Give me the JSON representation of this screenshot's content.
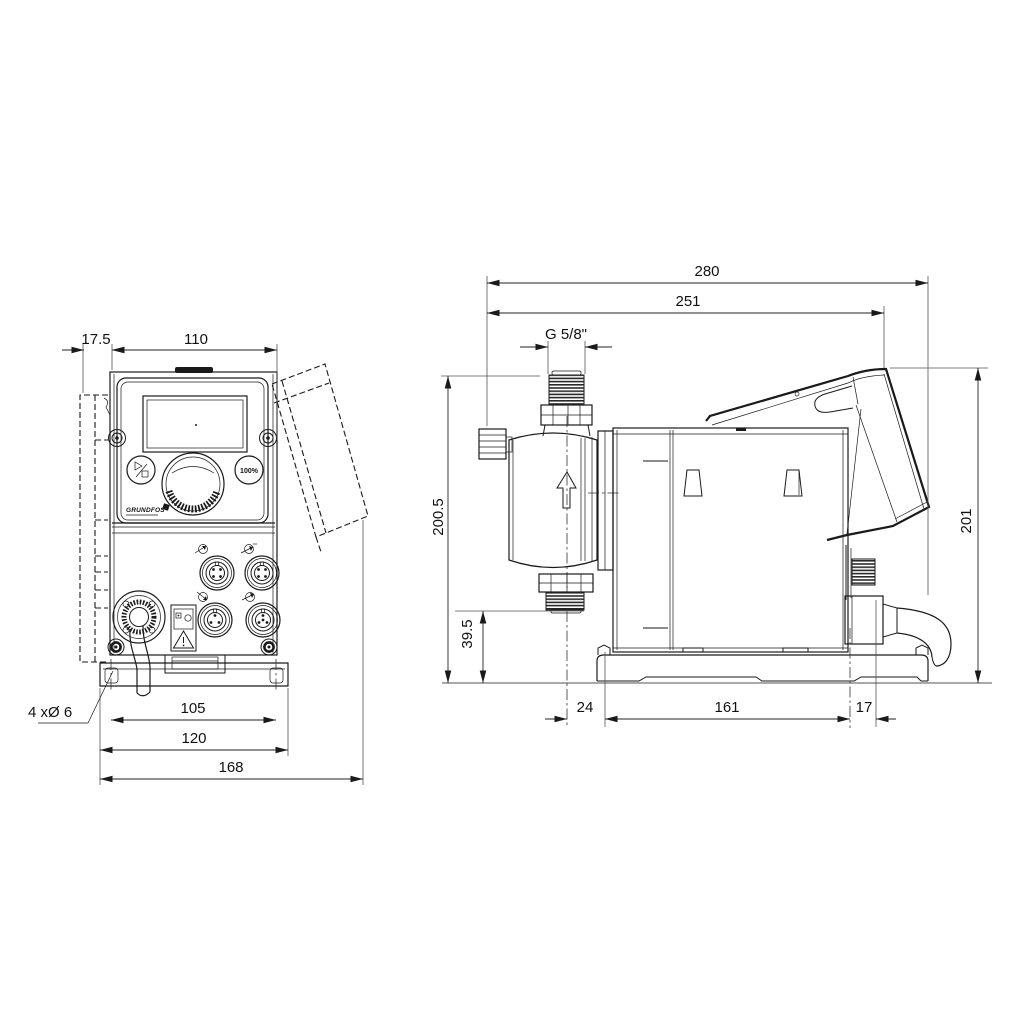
{
  "drawing": {
    "front_view": {
      "name": "front view",
      "dims": {
        "back_plate_offset": "17.5",
        "housing_width": "110",
        "mounting_hole_spacing": "105",
        "base_plate_width": "120",
        "overall_width_lid_open": "168"
      },
      "mounting_holes_note": "4 xØ 6",
      "control_panel": {
        "logo_text": "GRUNDFOS",
        "max_button_label": "100%"
      }
    },
    "side_view": {
      "name": "side view",
      "dims": {
        "overall_depth": "280",
        "depth_to_lid_edge": "251",
        "connection_thread": "G 5/8\"",
        "height_to_connection_top": "200.5",
        "connection_clearance_height": "39.5",
        "head_center_to_plate": "24",
        "base_plate_depth": "161",
        "gland_overhang": "17",
        "overall_height_lid_open": "201"
      }
    },
    "icons": {
      "start_stop_icon": "play-stop glyph",
      "warning_icon": "warning-triangle",
      "flow_direction_icon": "up-arrow",
      "connector_icons": "signal-arrow circles",
      "connectors": "M12 round sockets x4"
    },
    "colors": {
      "line": "#1a1a1a",
      "background": "#ffffff"
    }
  }
}
